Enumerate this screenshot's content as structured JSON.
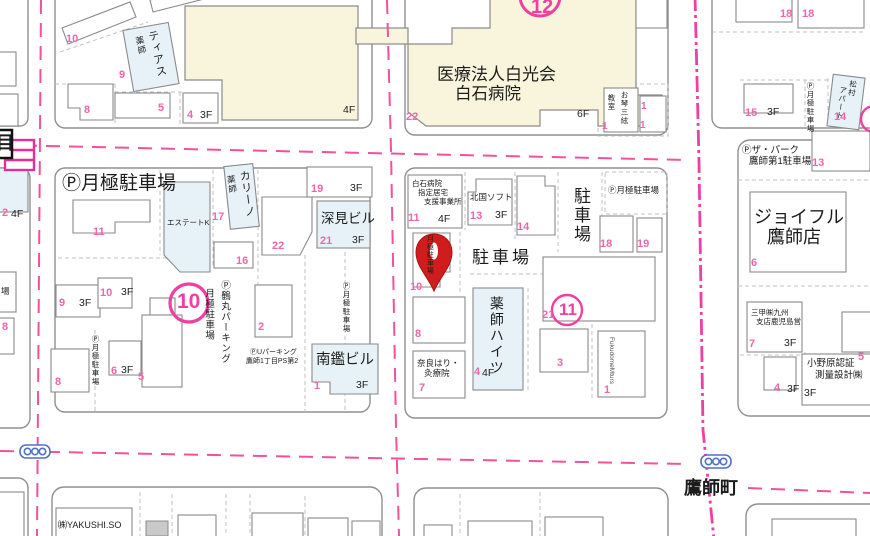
{
  "map_type": "residential-map",
  "colors": {
    "road_centerline": "#f3509e",
    "boundary_line": "#ee3fa4",
    "pink_number": "#f165ad",
    "cream_building": "#f8f5dc",
    "blue_building": "#e7f2f8",
    "marker_red": "#cf1d1d",
    "signal_blue": "#4f72c4",
    "outline_gray": "#8e8e8e"
  },
  "icons": {
    "pin": "location-marker",
    "signal": "traffic-light",
    "parking_symbol": "Ⓟ"
  },
  "nums": {
    "1": "1",
    "2": "2",
    "3": "3",
    "4": "4",
    "5": "5",
    "6": "6",
    "7": "7",
    "8": "8",
    "9": "9",
    "10": "10",
    "11": "11",
    "13": "13",
    "14": "14",
    "15": "15",
    "16": "16",
    "17": "17",
    "18": "18",
    "19": "19",
    "21": "21",
    "22": "22"
  },
  "floors": {
    "f3": "3F",
    "f4": "4F",
    "f6": "6F"
  },
  "circled": {
    "c10": "10",
    "c11": "11",
    "c12": "12"
  },
  "places": {
    "tias_a": "ティアス",
    "tias_b": "薬師",
    "hospital_line1": "医療法人白光会",
    "hospital_line2": "白石病院",
    "koto_a": "お琴三絃",
    "koto_b": "教室",
    "monthly_parking": "Ⓟ月極駐車場",
    "monthly_parking_plain": "月極駐車場",
    "matsumura_a": "松村",
    "matsumura_b": "アパート",
    "the_park_a": "Ⓟザ・パーク",
    "the_park_b": "鷹師第1駐車場",
    "joyful_a": "ジョイフル",
    "joyful_b": "鷹師店",
    "estate_k": "エステートK",
    "carino_a": "カリーノ",
    "carino_b": "薬師",
    "fukami_bldg": "深見ビル",
    "nankan_bldg": "南鑑ビル",
    "u_parking_a": "ⓅUパーキング",
    "u_parking_b": "鷹師1丁目PS第2",
    "tsurumaru": "Ⓟ鶴丸パーキング",
    "care_office_a": "白石病院",
    "care_office_b": "指定居宅",
    "care_office_c": "支援事業所",
    "kitaguni_soft": "北国ソフト",
    "parking_lot": "駐車場",
    "yakushi_heights": "薬師ハイツ",
    "nara_a": "奈良はり・",
    "nara_b": "灸療院",
    "fukudome": "FukudomeMturs",
    "sanko_a": "三甲㈱九州",
    "sanko_b": "支店鹿児島営",
    "onohara_a": "小野原認証",
    "onohara_b": "測量設計㈱",
    "yakushiso": "㈱YAKUSHI.SO",
    "takashicho": "鷹師町",
    "chome_edge": "目",
    "ba_edge": "場"
  }
}
